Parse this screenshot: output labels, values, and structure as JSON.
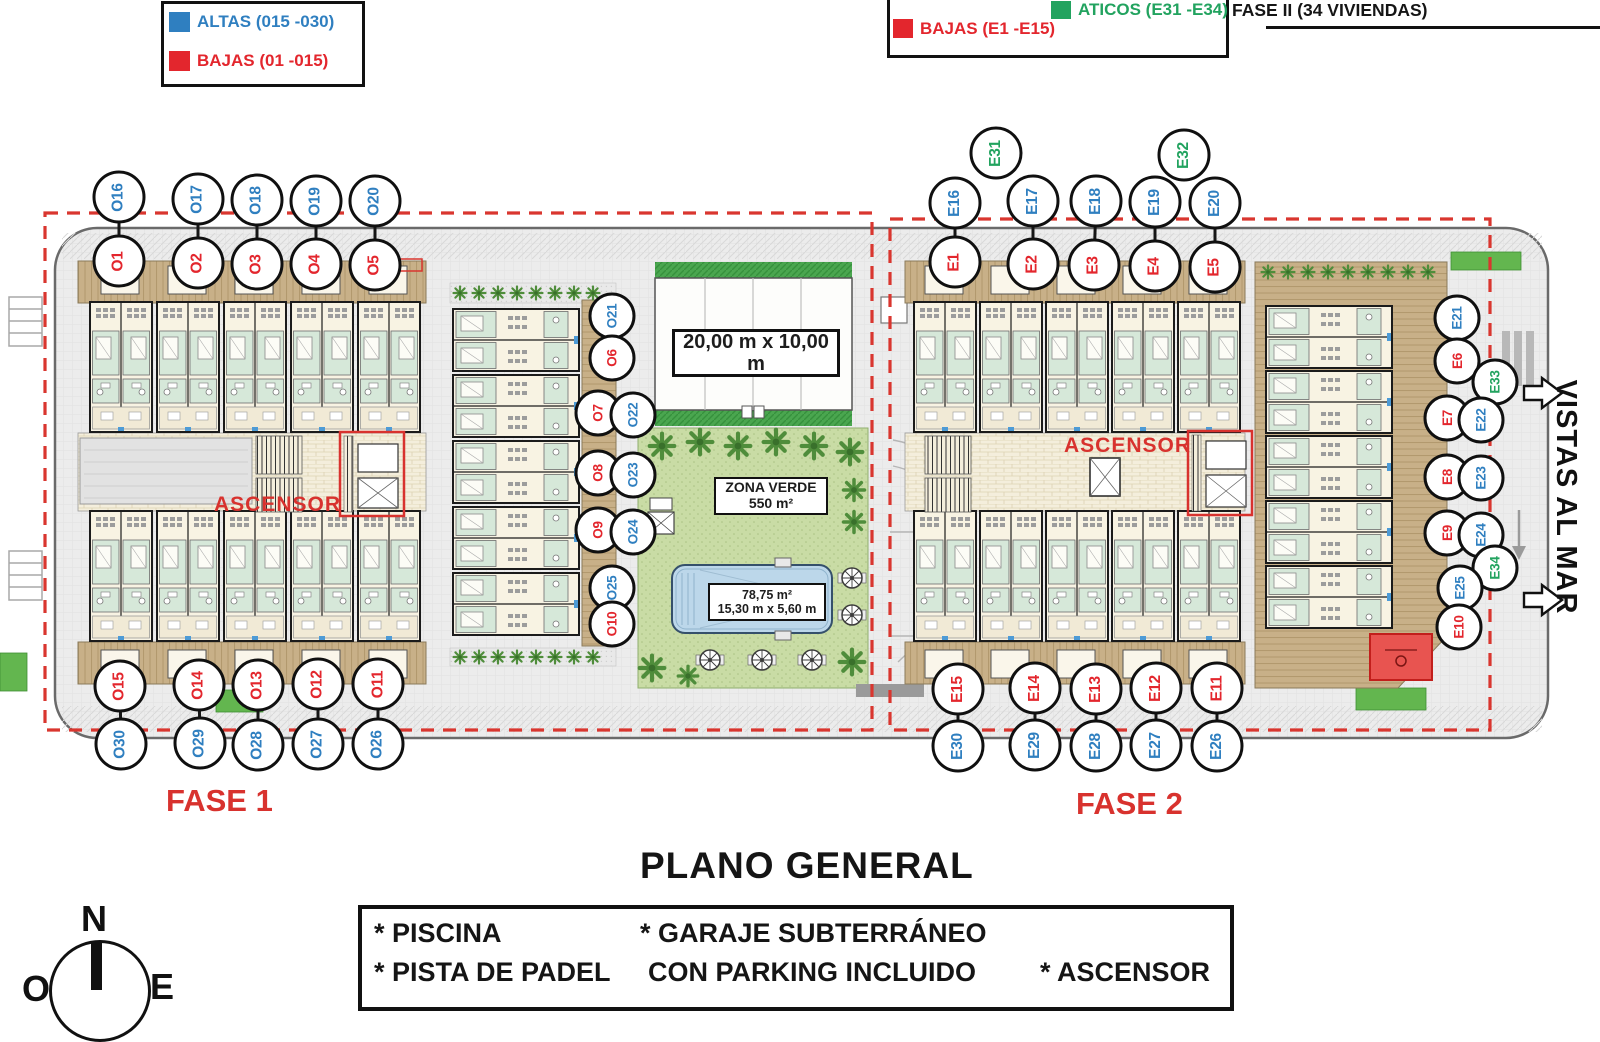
{
  "legend_fase1": {
    "altas_label": "ALTAS (015 -030)",
    "bajas_label": "BAJAS (01 -015)"
  },
  "legend_fase2": {
    "aticos_label": "ATICOS (E31 -E34)",
    "bajas_label": "BAJAS (E1 -E15)",
    "title": "FASE II (34 VIVIENDAS)"
  },
  "plan": {
    "ascensor": "ASCENSOR",
    "court_label": "20,00 m x 10,00 m",
    "zona_verde_line1": "ZONA VERDE",
    "zona_verde_line2": "550 m²",
    "pool_line1": "78,75 m²",
    "pool_line2": "15,30 m x 5,60 m",
    "vistas": "VISTAS AL MAR",
    "fase1": "FASE 1",
    "fase2": "FASE 2"
  },
  "titles": {
    "main": "PLANO GENERAL"
  },
  "info_box": {
    "piscina": "* PISCINA",
    "pista": "* PISTA DE PADEL",
    "garaje": "* GARAJE SUBTERRÁNEO",
    "parking": "CON PARKING INCLUIDO",
    "ascensor": "* ASCENSOR"
  },
  "compass": {
    "n": "N",
    "o": "O",
    "e": "E"
  },
  "colors": {
    "blue": "#2f7fc0",
    "red": "#e3262d",
    "green": "#22a35f"
  },
  "circles": [
    {
      "label": "O16",
      "x": 119,
      "y": 197,
      "color": "blue",
      "size": "lg"
    },
    {
      "label": "O17",
      "x": 198,
      "y": 199,
      "color": "blue",
      "size": "lg"
    },
    {
      "label": "O18",
      "x": 257,
      "y": 200,
      "color": "blue",
      "size": "lg"
    },
    {
      "label": "O19",
      "x": 316,
      "y": 201,
      "color": "blue",
      "size": "lg"
    },
    {
      "label": "O20",
      "x": 375,
      "y": 201,
      "color": "blue",
      "size": "lg"
    },
    {
      "label": "O1",
      "x": 119,
      "y": 261,
      "color": "red",
      "size": "lg"
    },
    {
      "label": "O2",
      "x": 198,
      "y": 263,
      "color": "red",
      "size": "lg"
    },
    {
      "label": "O3",
      "x": 257,
      "y": 264,
      "color": "red",
      "size": "lg"
    },
    {
      "label": "O4",
      "x": 316,
      "y": 264,
      "color": "red",
      "size": "lg"
    },
    {
      "label": "O5",
      "x": 375,
      "y": 265,
      "color": "red",
      "size": "lg"
    },
    {
      "label": "O15",
      "x": 120,
      "y": 686,
      "color": "red",
      "size": "lg"
    },
    {
      "label": "O14",
      "x": 199,
      "y": 685,
      "color": "red",
      "size": "lg"
    },
    {
      "label": "O13",
      "x": 258,
      "y": 685,
      "color": "red",
      "size": "lg"
    },
    {
      "label": "O12",
      "x": 318,
      "y": 684,
      "color": "red",
      "size": "lg"
    },
    {
      "label": "O11",
      "x": 378,
      "y": 684,
      "color": "red",
      "size": "lg"
    },
    {
      "label": "O30",
      "x": 121,
      "y": 744,
      "color": "blue",
      "size": "lg"
    },
    {
      "label": "O29",
      "x": 200,
      "y": 743,
      "color": "blue",
      "size": "lg"
    },
    {
      "label": "O28",
      "x": 258,
      "y": 745,
      "color": "blue",
      "size": "lg"
    },
    {
      "label": "O27",
      "x": 318,
      "y": 744,
      "color": "blue",
      "size": "lg"
    },
    {
      "label": "O26",
      "x": 378,
      "y": 744,
      "color": "blue",
      "size": "lg"
    },
    {
      "label": "O21",
      "x": 612,
      "y": 316,
      "color": "blue",
      "size": "sm"
    },
    {
      "label": "O6",
      "x": 612,
      "y": 358,
      "color": "red",
      "size": "sm"
    },
    {
      "label": "O7",
      "x": 598,
      "y": 413,
      "color": "red",
      "size": "sm"
    },
    {
      "label": "O22",
      "x": 633,
      "y": 415,
      "color": "blue",
      "size": "sm"
    },
    {
      "label": "O8",
      "x": 598,
      "y": 473,
      "color": "red",
      "size": "sm"
    },
    {
      "label": "O23",
      "x": 633,
      "y": 475,
      "color": "blue",
      "size": "sm"
    },
    {
      "label": "O9",
      "x": 598,
      "y": 530,
      "color": "red",
      "size": "sm"
    },
    {
      "label": "O24",
      "x": 633,
      "y": 532,
      "color": "blue",
      "size": "sm"
    },
    {
      "label": "O25",
      "x": 612,
      "y": 588,
      "color": "blue",
      "size": "sm"
    },
    {
      "label": "O10",
      "x": 612,
      "y": 624,
      "color": "red",
      "size": "sm"
    },
    {
      "label": "E31",
      "x": 996,
      "y": 153,
      "color": "green",
      "size": "lg"
    },
    {
      "label": "E32",
      "x": 1184,
      "y": 155,
      "color": "green",
      "size": "lg"
    },
    {
      "label": "E16",
      "x": 955,
      "y": 203,
      "color": "blue",
      "size": "lg"
    },
    {
      "label": "E17",
      "x": 1033,
      "y": 201,
      "color": "blue",
      "size": "lg"
    },
    {
      "label": "E18",
      "x": 1096,
      "y": 201,
      "color": "blue",
      "size": "lg"
    },
    {
      "label": "E19",
      "x": 1155,
      "y": 202,
      "color": "blue",
      "size": "lg"
    },
    {
      "label": "E20",
      "x": 1215,
      "y": 203,
      "color": "blue",
      "size": "lg"
    },
    {
      "label": "E1",
      "x": 955,
      "y": 262,
      "color": "red",
      "size": "lg"
    },
    {
      "label": "E2",
      "x": 1033,
      "y": 264,
      "color": "red",
      "size": "lg"
    },
    {
      "label": "E3",
      "x": 1094,
      "y": 265,
      "color": "red",
      "size": "lg"
    },
    {
      "label": "E4",
      "x": 1155,
      "y": 266,
      "color": "red",
      "size": "lg"
    },
    {
      "label": "E5",
      "x": 1215,
      "y": 267,
      "color": "red",
      "size": "lg"
    },
    {
      "label": "E15",
      "x": 958,
      "y": 689,
      "color": "red",
      "size": "lg"
    },
    {
      "label": "E14",
      "x": 1035,
      "y": 688,
      "color": "red",
      "size": "lg"
    },
    {
      "label": "E13",
      "x": 1096,
      "y": 689,
      "color": "red",
      "size": "lg"
    },
    {
      "label": "E12",
      "x": 1156,
      "y": 688,
      "color": "red",
      "size": "lg"
    },
    {
      "label": "E11",
      "x": 1217,
      "y": 688,
      "color": "red",
      "size": "lg"
    },
    {
      "label": "E30",
      "x": 958,
      "y": 746,
      "color": "blue",
      "size": "lg"
    },
    {
      "label": "E29",
      "x": 1035,
      "y": 745,
      "color": "blue",
      "size": "lg"
    },
    {
      "label": "E28",
      "x": 1096,
      "y": 746,
      "color": "blue",
      "size": "lg"
    },
    {
      "label": "E27",
      "x": 1156,
      "y": 745,
      "color": "blue",
      "size": "lg"
    },
    {
      "label": "E26",
      "x": 1217,
      "y": 746,
      "color": "blue",
      "size": "lg"
    },
    {
      "label": "E21",
      "x": 1457,
      "y": 318,
      "color": "blue",
      "size": "sm"
    },
    {
      "label": "E6",
      "x": 1457,
      "y": 361,
      "color": "red",
      "size": "sm"
    },
    {
      "label": "E33",
      "x": 1495,
      "y": 382,
      "color": "green",
      "size": "sm"
    },
    {
      "label": "E7",
      "x": 1447,
      "y": 418,
      "color": "red",
      "size": "sm"
    },
    {
      "label": "E22",
      "x": 1481,
      "y": 420,
      "color": "blue",
      "size": "sm"
    },
    {
      "label": "E8",
      "x": 1447,
      "y": 477,
      "color": "red",
      "size": "sm"
    },
    {
      "label": "E23",
      "x": 1481,
      "y": 478,
      "color": "blue",
      "size": "sm"
    },
    {
      "label": "E9",
      "x": 1447,
      "y": 533,
      "color": "red",
      "size": "sm"
    },
    {
      "label": "E24",
      "x": 1481,
      "y": 535,
      "color": "blue",
      "size": "sm"
    },
    {
      "label": "E34",
      "x": 1495,
      "y": 568,
      "color": "green",
      "size": "sm"
    },
    {
      "label": "E25",
      "x": 1460,
      "y": 588,
      "color": "blue",
      "size": "sm"
    },
    {
      "label": "E10",
      "x": 1459,
      "y": 627,
      "color": "red",
      "size": "sm"
    }
  ],
  "pairs": [
    [
      "O16",
      "O1"
    ],
    [
      "O17",
      "O2"
    ],
    [
      "O18",
      "O3"
    ],
    [
      "O19",
      "O4"
    ],
    [
      "O20",
      "O5"
    ],
    [
      "O15",
      "O30"
    ],
    [
      "O14",
      "O29"
    ],
    [
      "O13",
      "O28"
    ],
    [
      "O12",
      "O27"
    ],
    [
      "O11",
      "O26"
    ],
    [
      "O21",
      "O6"
    ],
    [
      "O7",
      "O22"
    ],
    [
      "O8",
      "O23"
    ],
    [
      "O9",
      "O24"
    ],
    [
      "O25",
      "O10"
    ],
    [
      "E16",
      "E1"
    ],
    [
      "E17",
      "E2"
    ],
    [
      "E18",
      "E3"
    ],
    [
      "E19",
      "E4"
    ],
    [
      "E20",
      "E5"
    ],
    [
      "E15",
      "E30"
    ],
    [
      "E14",
      "E29"
    ],
    [
      "E13",
      "E28"
    ],
    [
      "E12",
      "E27"
    ],
    [
      "E11",
      "E26"
    ],
    [
      "E21",
      "E6"
    ],
    [
      "E7",
      "E22"
    ],
    [
      "E8",
      "E23"
    ],
    [
      "E9",
      "E24"
    ],
    [
      "E25",
      "E10"
    ]
  ]
}
